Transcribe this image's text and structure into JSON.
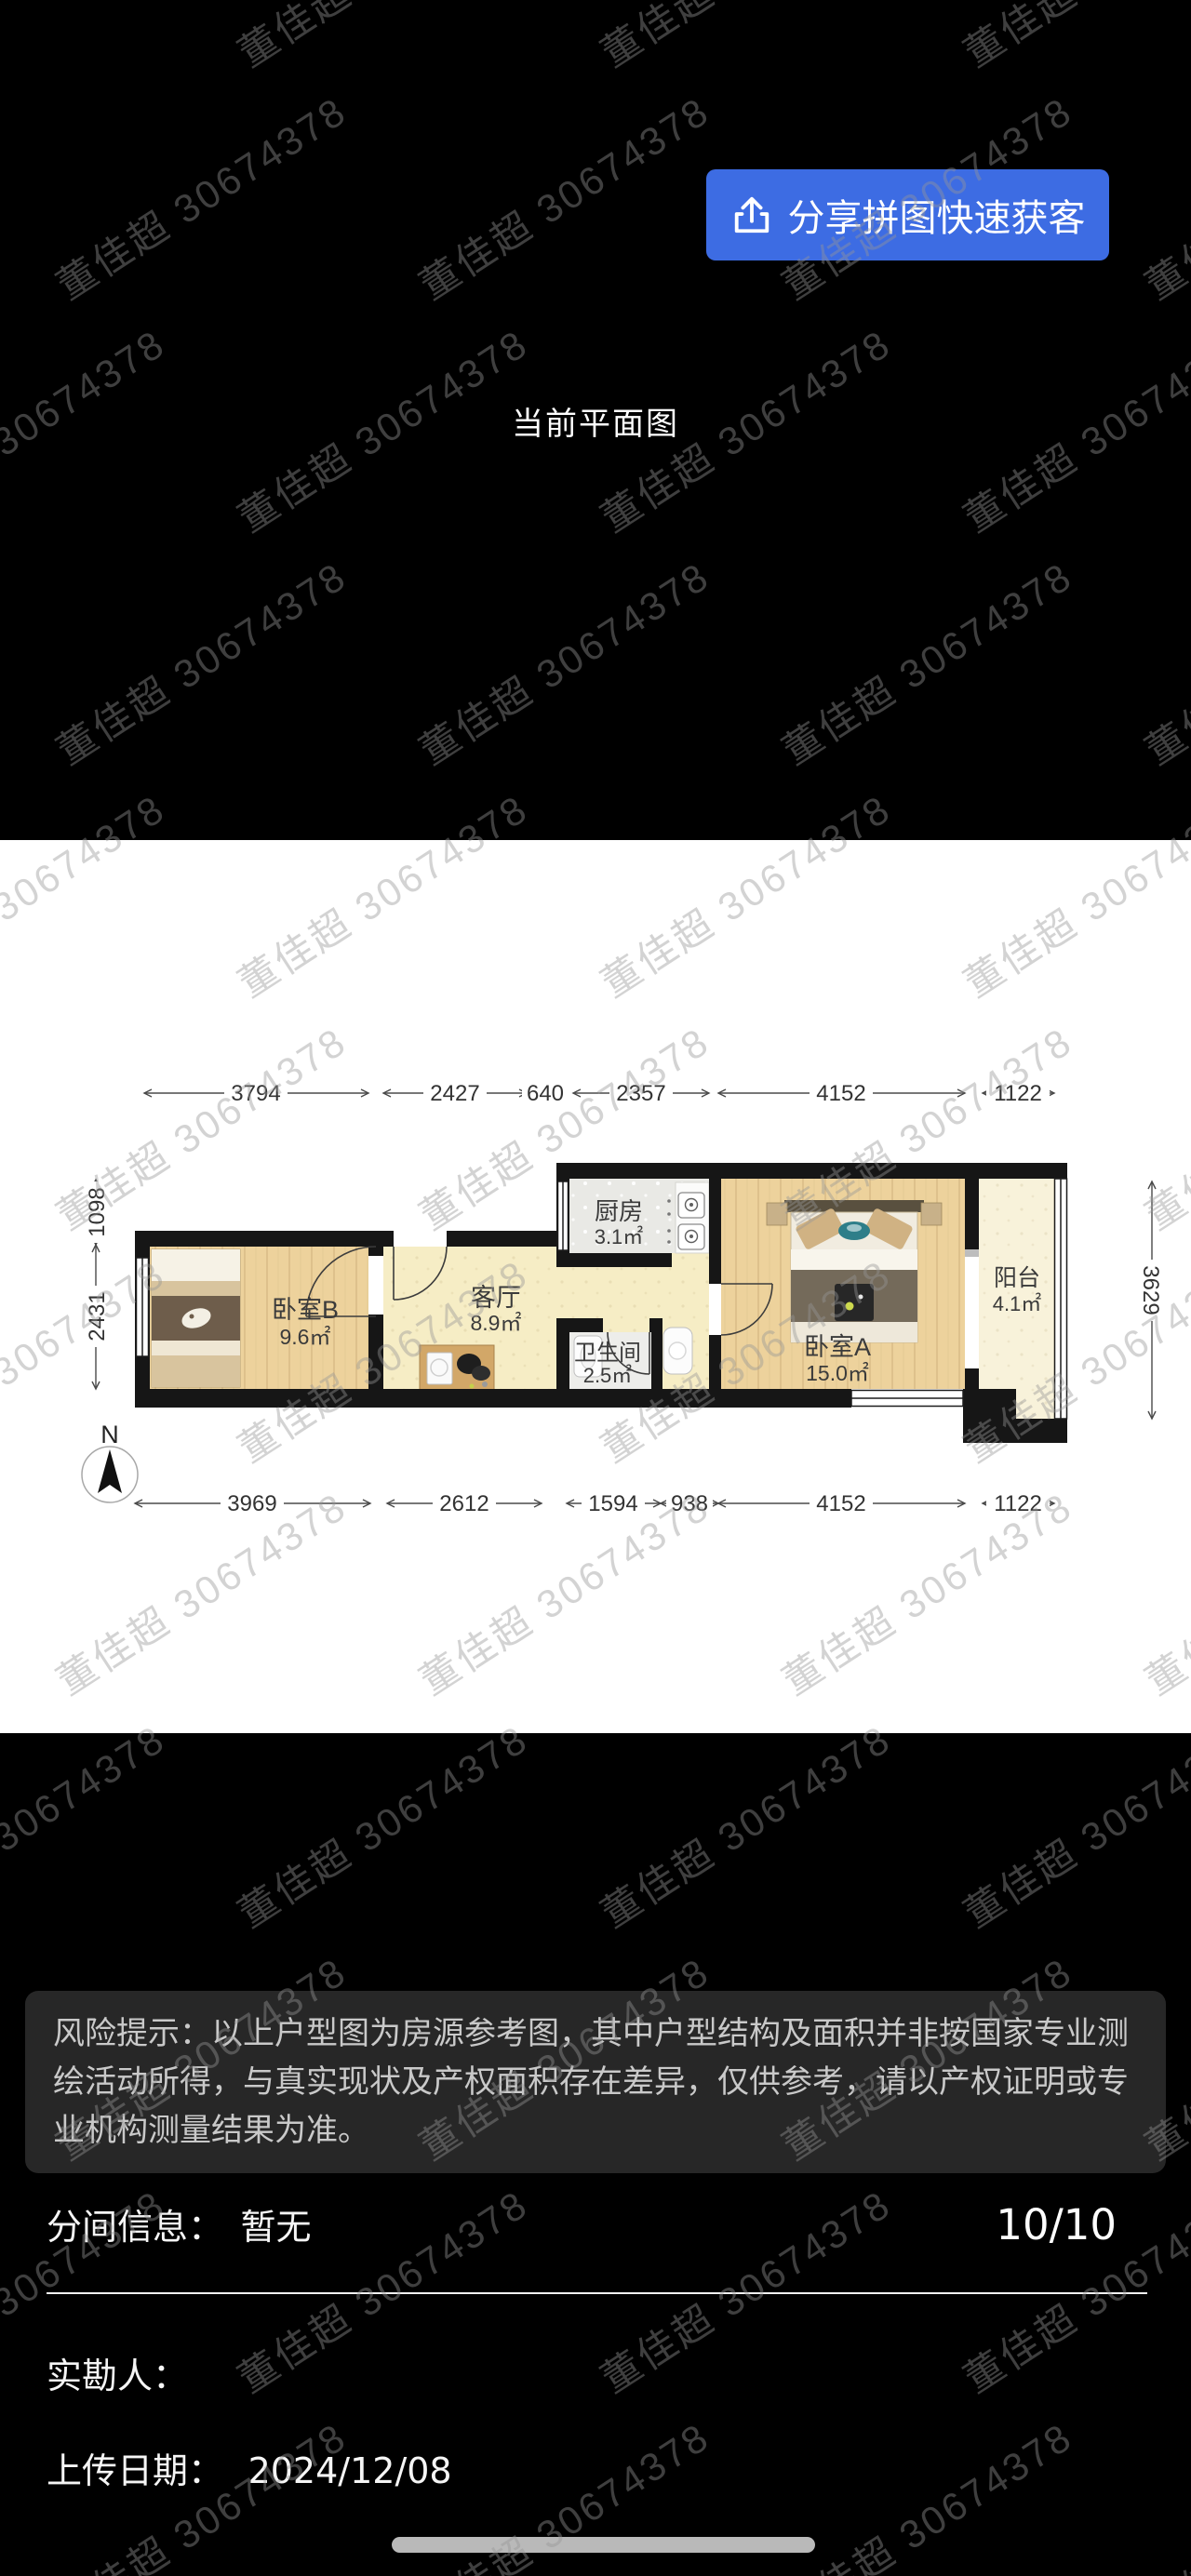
{
  "watermark": {
    "text": "董佳超 30674378"
  },
  "colors": {
    "accent_blue": "#3D6CE3",
    "plan_background": "#ffffff",
    "page_background": "#000000"
  },
  "header": {
    "share_button_label": "分享拼图快速获客",
    "title": "当前平面图"
  },
  "floorplan": {
    "rooms": [
      {
        "name": "卧室B",
        "area": "9.6㎡"
      },
      {
        "name": "客厅",
        "area": "8.9㎡"
      },
      {
        "name": "厨房",
        "area": "3.1㎡"
      },
      {
        "name": "卫生间",
        "area": "2.5㎡"
      },
      {
        "name": "卧室A",
        "area": "15.0㎡"
      },
      {
        "name": "阳台",
        "area": "4.1㎡"
      }
    ],
    "dims_top": [
      "3794",
      "2427",
      "640",
      "2357",
      "4152",
      "1122"
    ],
    "dims_bottom": [
      "3969",
      "2612",
      "1594",
      "938",
      "4152",
      "1122"
    ],
    "dims_left": [
      "1098",
      "2431"
    ],
    "dims_right": [
      "3629"
    ],
    "north_label": "N"
  },
  "notice": {
    "text": "风险提示：以上户型图为房源参考图，其中户型结构及面积并非按国家专业测绘活动所得，与真实现状及产权面积存在差异，仅供参考，请以产权证明或专业机构测量结果为准。"
  },
  "info": {
    "partition_label": "分间信息：",
    "partition_value": "暂无",
    "page_indicator": "10/10",
    "surveyor_label": "实勘人：",
    "upload_label": "上传日期：",
    "upload_value": "2024/12/08"
  }
}
